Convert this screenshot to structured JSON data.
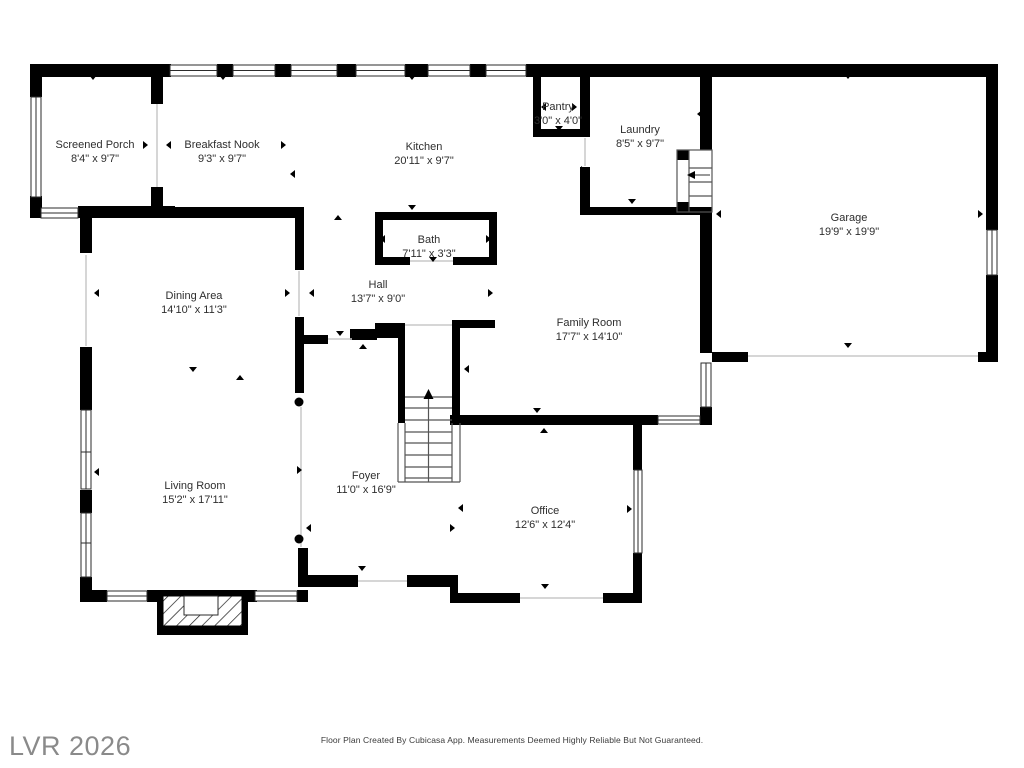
{
  "colors": {
    "wall": "#000000",
    "background": "#ffffff",
    "label_text": "#2e2e2e",
    "watermark_text": "#8a8a8a",
    "footer_text": "#3a3a3a"
  },
  "rooms": [
    {
      "id": "screened-porch",
      "name": "Screened Porch",
      "dims": "8'4\" x 9'7\""
    },
    {
      "id": "breakfast-nook",
      "name": "Breakfast Nook",
      "dims": "9'3\" x 9'7\""
    },
    {
      "id": "kitchen",
      "name": "Kitchen",
      "dims": "20'11\" x 9'7\""
    },
    {
      "id": "pantry",
      "name": "Pantry",
      "dims": "3'0\" x 4'0\""
    },
    {
      "id": "laundry",
      "name": "Laundry",
      "dims": "8'5\" x 9'7\""
    },
    {
      "id": "garage",
      "name": "Garage",
      "dims": "19'9\" x 19'9\""
    },
    {
      "id": "bath",
      "name": "Bath",
      "dims": "7'11\" x 3'3\""
    },
    {
      "id": "hall",
      "name": "Hall",
      "dims": "13'7\" x 9'0\""
    },
    {
      "id": "dining-area",
      "name": "Dining Area",
      "dims": "14'10\" x 11'3\""
    },
    {
      "id": "family-room",
      "name": "Family Room",
      "dims": "17'7\" x 14'10\""
    },
    {
      "id": "living-room",
      "name": "Living Room",
      "dims": "15'2\" x 17'11\""
    },
    {
      "id": "foyer",
      "name": "Foyer",
      "dims": "11'0\" x 16'9\""
    },
    {
      "id": "office",
      "name": "Office",
      "dims": "12'6\" x 12'4\""
    }
  ],
  "footer": {
    "text": "Floor Plan Created By Cubicasa App. Measurements Deemed Highly Reliable But Not Guaranteed."
  },
  "watermark": {
    "text": "LVR 2026"
  }
}
